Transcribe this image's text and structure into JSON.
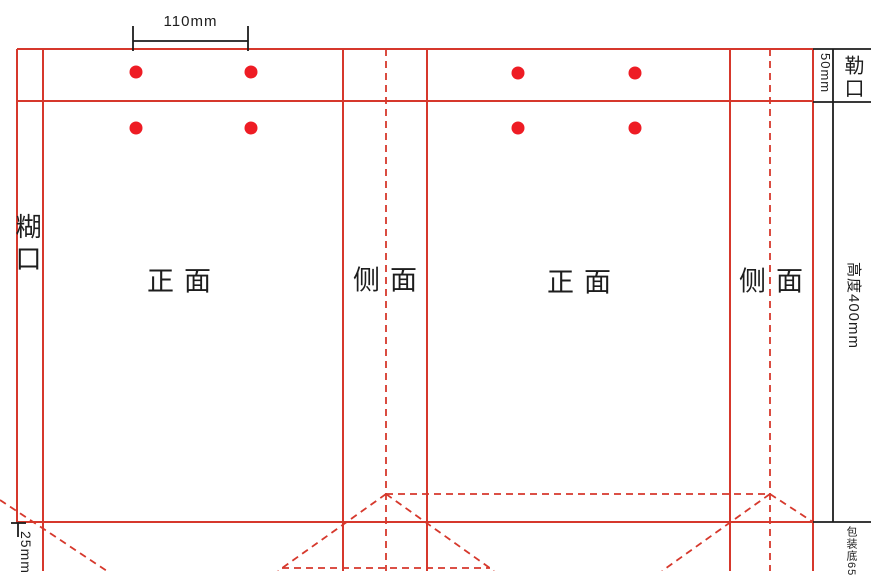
{
  "colors": {
    "line_red": "#d6382c",
    "dot_red": "#ee1c24",
    "dim_black": "#1d1d1d"
  },
  "labels": {
    "glue_flap": "糊口",
    "front_panel_left": "正面",
    "side_panel_left": "侧面",
    "front_panel_right": "正面",
    "side_panel_right": "侧面",
    "top_fold_flap": "勒口",
    "bottom_panel": "包装底65"
  },
  "dimensions": {
    "hole_spacing": "110mm",
    "top_fold_height": "50mm",
    "bag_height": "高度400mm",
    "bottom_fold": "25mm"
  },
  "holes": [
    {
      "cx": 136,
      "cy": 72
    },
    {
      "cx": 251,
      "cy": 72
    },
    {
      "cx": 136,
      "cy": 128
    },
    {
      "cx": 251,
      "cy": 128
    },
    {
      "cx": 518,
      "cy": 73
    },
    {
      "cx": 635,
      "cy": 73
    },
    {
      "cx": 518,
      "cy": 128
    },
    {
      "cx": 635,
      "cy": 128
    }
  ]
}
